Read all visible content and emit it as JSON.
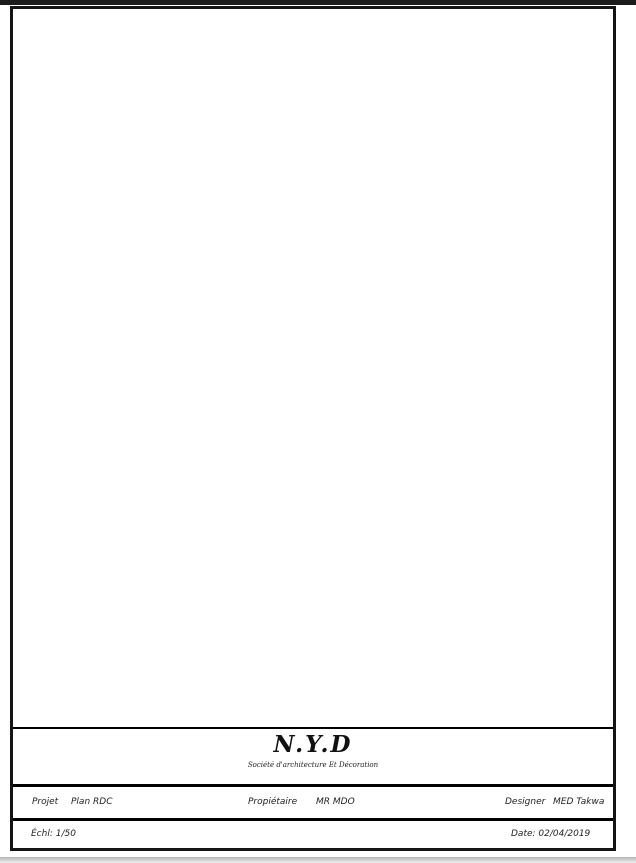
{
  "colors": {
    "wall": "#161616",
    "furniture": "#2fa99e",
    "window_fill": "#c9ecf4",
    "window_stroke": "#2b9cc0",
    "door": "#2b9cc0",
    "veranda_line": "#3fb5d8",
    "dim_line": "#777777",
    "dim_text": "#333333",
    "label": "#2f2f2f",
    "tree_red": "#d94a1a",
    "tree_green": "#52c228",
    "tree_olive": "#78a826",
    "plant": "#3fc02a"
  },
  "rooms": [
    {
      "label": "Suit.",
      "x": 192,
      "y": 178,
      "size": 8
    },
    {
      "label": "parent",
      "x": 194,
      "y": 190,
      "size": 8
    },
    {
      "label": "Ch.1",
      "x": 325,
      "y": 180,
      "size": 8
    },
    {
      "label": "Ch.02",
      "x": 420,
      "y": 162,
      "size": 8
    },
    {
      "label": "Cuisine",
      "x": 199,
      "y": 308,
      "size": 8
    },
    {
      "label": "S.A.M",
      "x": 424,
      "y": 312,
      "size": 7
    },
    {
      "label": "Veranda",
      "x": 510,
      "y": 439,
      "size": 8
    },
    {
      "label": "Séjour",
      "x": 383,
      "y": 488,
      "size": 8
    },
    {
      "label": "Salon",
      "x": 281,
      "y": 525,
      "size": 8
    },
    {
      "label": "Cour",
      "x": 186,
      "y": 538,
      "size": 8
    },
    {
      "label": "ENT",
      "x": 371,
      "y": 583,
      "size": 4.5
    }
  ],
  "dimensions": {
    "top_rows": [
      {
        "y": 17,
        "x1": 95,
        "x2": 541,
        "labels": [
          {
            "v": "1562",
            "x": 318
          }
        ]
      },
      {
        "y": 31,
        "x1": 95,
        "x2": 541,
        "labels": [
          {
            "v": "150",
            "x": 116
          },
          {
            "v": "1154",
            "x": 318
          },
          {
            "v": "258",
            "x": 505
          }
        ]
      },
      {
        "y": 45,
        "x1": 95,
        "x2": 541,
        "labels": [
          {
            "v": "160",
            "x": 117
          },
          {
            "v": "120",
            "x": 155
          },
          {
            "v": "540",
            "x": 193
          },
          {
            "v": "280",
            "x": 255
          },
          {
            "v": "540",
            "x": 313
          },
          {
            "v": "213",
            "x": 367
          },
          {
            "v": "540",
            "x": 413
          },
          {
            "v": "120",
            "x": 450
          },
          {
            "v": "258",
            "x": 510
          }
        ]
      },
      {
        "y": 60,
        "x1": 95,
        "x2": 541,
        "labels": [
          {
            "v": "150",
            "x": 118
          },
          {
            "v": "35",
            "x": 141
          },
          {
            "v": "400",
            "x": 204
          },
          {
            "v": "15",
            "x": 266
          },
          {
            "v": "340",
            "x": 316
          },
          {
            "v": "15",
            "x": 364
          },
          {
            "v": "332",
            "x": 399
          },
          {
            "v": "35",
            "x": 468
          },
          {
            "v": "258",
            "x": 513
          }
        ]
      }
    ],
    "bottom_rows": [
      {
        "y": 647,
        "x1": 95,
        "x2": 543,
        "labels": [
          {
            "v": "150",
            "x": 115
          },
          {
            "v": "35",
            "x": 142
          },
          {
            "v": "288",
            "x": 188
          },
          {
            "v": "15",
            "x": 232
          },
          {
            "v": "364",
            "x": 287
          },
          {
            "v": "28",
            "x": 343
          },
          {
            "v": "402",
            "x": 407
          },
          {
            "v": "35",
            "x": 467
          },
          {
            "v": "265",
            "x": 510
          }
        ]
      },
      {
        "y": 663,
        "x1": 95,
        "x2": 543,
        "labels": [
          {
            "v": "150",
            "x": 115
          },
          {
            "v": "285",
            "x": 187
          },
          {
            "v": "127",
            "x": 247
          },
          {
            "v": "140",
            "x": 285
          },
          {
            "v": "170",
            "x": 330
          },
          {
            "v": "130",
            "x": 373
          },
          {
            "v": "277",
            "x": 433
          },
          {
            "v": "265",
            "x": 510
          }
        ]
      },
      {
        "y": 678,
        "x1": 95,
        "x2": 543,
        "labels": [
          {
            "v": "150",
            "x": 115
          },
          {
            "v": "310",
            "x": 185
          },
          {
            "v": "259",
            "x": 287
          },
          {
            "v": "445",
            "x": 407
          },
          {
            "v": "265",
            "x": 510
          }
        ]
      },
      {
        "y": 693,
        "x1": 95,
        "x2": 543,
        "labels": [
          {
            "v": "1562",
            "x": 322
          }
        ]
      }
    ],
    "left_lines": [
      {
        "x": 25,
        "y1": 92,
        "y2": 628
      },
      {
        "x": 38,
        "y1": 92,
        "y2": 628
      },
      {
        "x": 53,
        "y1": 92,
        "y2": 628
      },
      {
        "x": 68,
        "y1": 92,
        "y2": 628
      }
    ],
    "right_lines": [
      {
        "x": 562,
        "y1": 92,
        "y2": 628
      },
      {
        "x": 575,
        "y1": 92,
        "y2": 628
      },
      {
        "x": 590,
        "y1": 92,
        "y2": 628
      },
      {
        "x": 605,
        "y1": 92,
        "y2": 628
      }
    ],
    "left_labels": [
      {
        "x": 34,
        "y": 161,
        "v": "435"
      },
      {
        "x": 60,
        "y": 167,
        "v": "440"
      },
      {
        "x": 46,
        "y": 186,
        "v": "506"
      },
      {
        "x": 55,
        "y": 222,
        "v": "15"
      },
      {
        "x": 46,
        "y": 290,
        "v": "140"
      },
      {
        "x": 32,
        "y": 299,
        "v": "400"
      },
      {
        "x": 60,
        "y": 304,
        "v": "435"
      },
      {
        "x": 46,
        "y": 318,
        "v": "105"
      },
      {
        "x": 14,
        "y": 328,
        "v": "1614"
      },
      {
        "x": 46,
        "y": 356,
        "v": "100"
      },
      {
        "x": 56,
        "y": 360,
        "v": "15"
      },
      {
        "x": 12,
        "y": 359,
        "v": "1804"
      },
      {
        "x": 48,
        "y": 382,
        "v": "70"
      },
      {
        "x": 59,
        "y": 394,
        "v": "135"
      },
      {
        "x": 55,
        "y": 421,
        "v": "15"
      },
      {
        "x": 46,
        "y": 433,
        "v": "165"
      },
      {
        "x": 31,
        "y": 446,
        "v": "519"
      },
      {
        "x": 46,
        "y": 465,
        "v": "60"
      },
      {
        "x": 59,
        "y": 465,
        "v": "320"
      },
      {
        "x": 46,
        "y": 497,
        "v": "150"
      },
      {
        "x": 55,
        "y": 504,
        "v": "25"
      },
      {
        "x": 42,
        "y": 540,
        "v": "150"
      },
      {
        "x": 54,
        "y": 536,
        "v": "125"
      },
      {
        "x": 40,
        "y": 557,
        "v": "25"
      },
      {
        "x": 34,
        "y": 593,
        "v": "20"
      },
      {
        "x": 50,
        "y": 593,
        "v": "20"
      }
    ],
    "right_labels": [
      {
        "x": 552,
        "y": 104,
        "v": "15"
      },
      {
        "x": 555,
        "y": 188,
        "v": "936"
      },
      {
        "x": 566,
        "y": 215,
        "v": "817.5"
      },
      {
        "x": 559,
        "y": 264,
        "v": "15"
      },
      {
        "x": 583,
        "y": 329,
        "v": "1514"
      },
      {
        "x": 597,
        "y": 361,
        "v": "1924"
      },
      {
        "x": 566,
        "y": 368,
        "v": "200"
      },
      {
        "x": 554,
        "y": 415,
        "v": "90"
      },
      {
        "x": 567,
        "y": 419,
        "v": "95"
      },
      {
        "x": 568,
        "y": 449,
        "v": "120"
      },
      {
        "x": 568,
        "y": 486,
        "v": "135"
      },
      {
        "x": 568,
        "y": 520,
        "v": "120"
      },
      {
        "x": 561,
        "y": 545,
        "v": "25"
      },
      {
        "x": 568,
        "y": 552,
        "v": "15"
      },
      {
        "x": 553,
        "y": 581,
        "v": "120"
      },
      {
        "x": 566,
        "y": 581,
        "v": "120"
      },
      {
        "x": 583,
        "y": 596,
        "v": "20"
      },
      {
        "x": 553,
        "y": 612,
        "v": "60"
      },
      {
        "x": 566,
        "y": 612,
        "v": "60"
      }
    ],
    "inner_labels": [
      {
        "x": 296,
        "y": 250,
        "v": "445"
      },
      {
        "x": 331,
        "y": 254,
        "v": "120"
      },
      {
        "x": 324,
        "y": 298,
        "v": "130"
      },
      {
        "x": 250,
        "y": 383,
        "v": "337"
      },
      {
        "x": 274,
        "y": 397,
        "v": "130"
      }
    ]
  },
  "trees": [
    {
      "cx": 140,
      "cy": 597,
      "r": 30,
      "palette": [
        "#c03014",
        "#d94a1a",
        "#e8722a",
        "#f2a12e",
        "#a8280f"
      ]
    },
    {
      "cx": 217,
      "cy": 596,
      "r": 29,
      "palette": [
        "#2e9e2e",
        "#52c228",
        "#8fd430",
        "#ffd21c",
        "#2a8f2a"
      ]
    },
    {
      "cx": 295,
      "cy": 597,
      "r": 28,
      "palette": [
        "#5e8f1e",
        "#78a826",
        "#8cbc30",
        "#a2ca40",
        "#527f1a"
      ]
    }
  ],
  "planter": {
    "bush_xs": [
      481,
      497,
      513,
      529,
      543
    ],
    "y": 578,
    "palette": [
      "#1f9e1f",
      "#3fc02a",
      "#7ad42e"
    ]
  },
  "title_block": {
    "company": "N.Y.D",
    "subtitle": "Société d'architecture Et Décoration",
    "projet_label": "Projet",
    "projet_value": "Plan RDC",
    "proprietaire_label": "Propiétaire",
    "proprietaire_value": "MR MDO",
    "designer_label": "Designer",
    "designer_value": "MED Takwa",
    "echelle": "Échl: 1/50",
    "date": "Date: 02/04/2019"
  }
}
